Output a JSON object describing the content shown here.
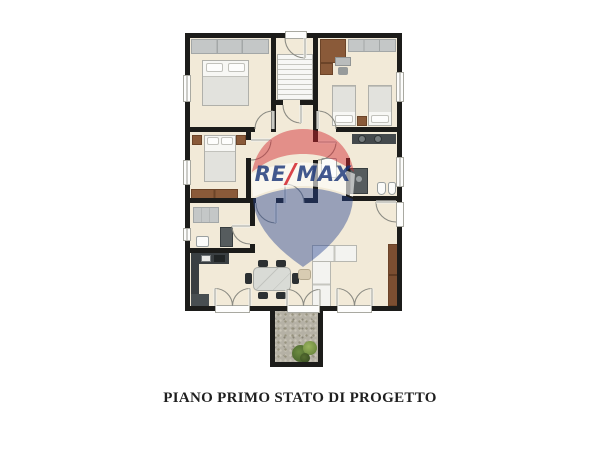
{
  "image": {
    "kind": "real-estate floor plan drawing",
    "caption": "PIANO PRIMO STATO DI PROGETTO"
  },
  "watermark": {
    "brand": "RE/MAX",
    "segments": {
      "re": "RE",
      "slash": "/",
      "max": "MAX"
    },
    "colors": {
      "balloon_red": "#D2232B",
      "balloon_blue": "#25418F",
      "text_blue": "#1A3577",
      "band_white": "#FFFFFF"
    }
  },
  "palette": {
    "background": "#FFFFFF",
    "wall": "#1C1C1A",
    "floor": "#F2EAD8",
    "wood_furniture": "#8A5A39",
    "kitchen_counter": "#3A3F42",
    "wardrobe_gray": "#C4C7C7",
    "balcony_gravel": "#B5B1A5",
    "plant_dark_green": "#4E6E33",
    "plant_light_green": "#7E9C4D"
  }
}
